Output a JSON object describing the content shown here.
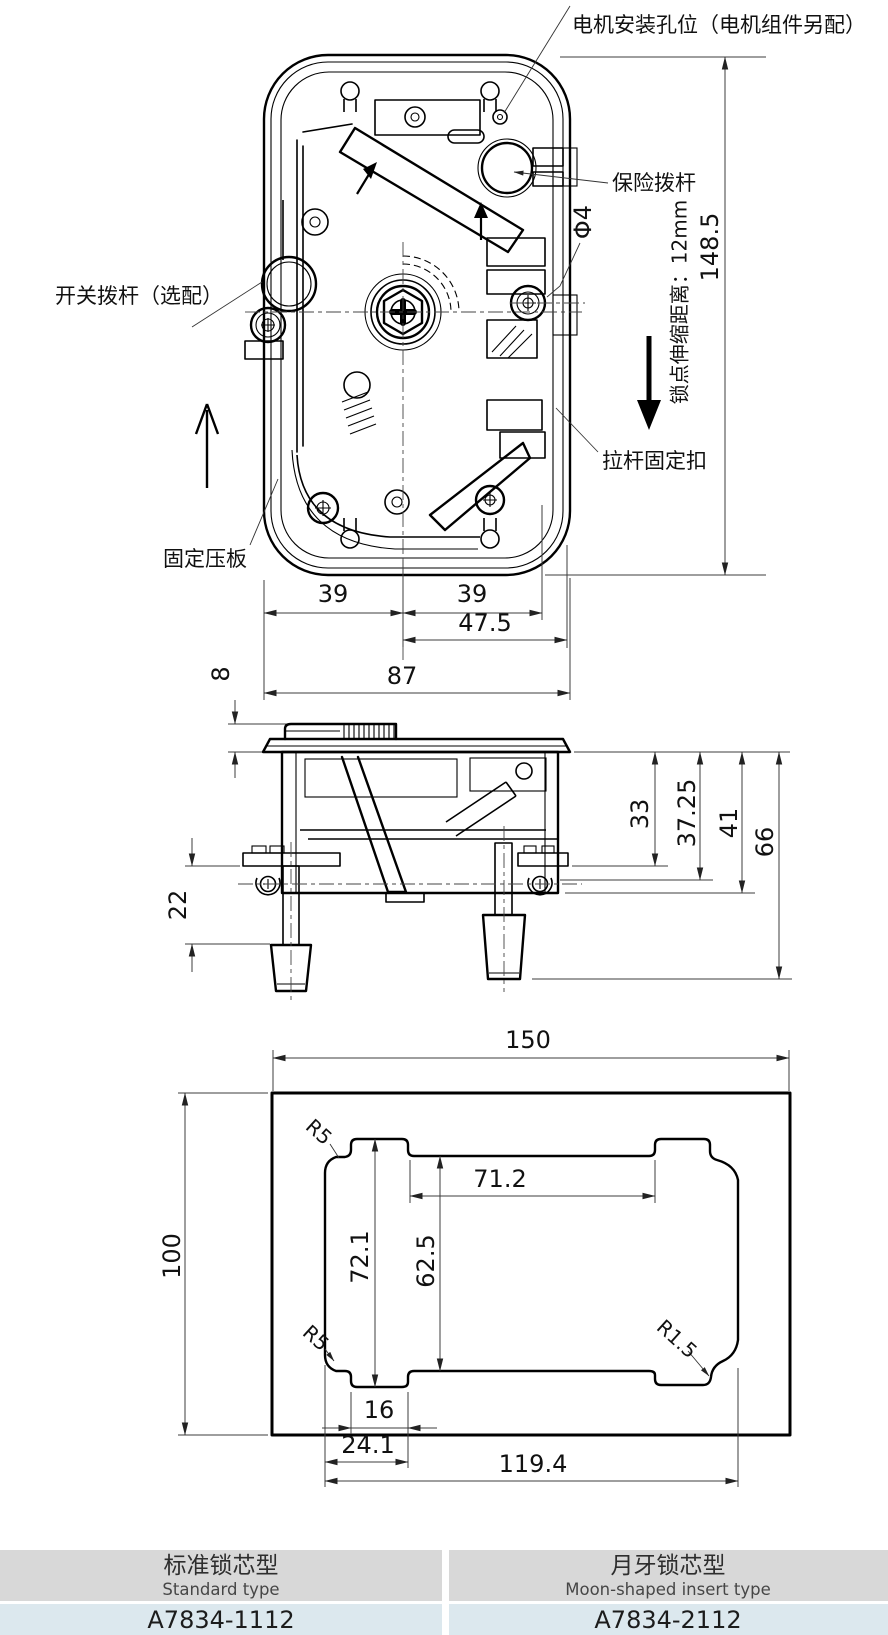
{
  "top_view": {
    "labels": {
      "motor_hole": "电机安装孔位（电机组件另配）",
      "safety_lever": "保险拨杆",
      "switch_lever": "开关拨杆（选配）",
      "fixing_plate": "固定压板",
      "rod_clip": "拉杆固定扣",
      "lock_stroke": "锁点伸缩距离：12mm",
      "hole_dia": "Φ4"
    },
    "dims": {
      "height": "148.5",
      "left_pitch": "39",
      "right_pitch": "39",
      "offset": "47.5",
      "width": "87",
      "plate_thickness": "8"
    }
  },
  "side_view": {
    "dims": {
      "d33": "33",
      "d37_25": "37.25",
      "d41": "41",
      "d66": "66",
      "rod_length": "22"
    }
  },
  "cutout_view": {
    "dims": {
      "panel_width": "150",
      "panel_height": "100",
      "top_opening": "71.2",
      "notch_span": "72.1",
      "opening_height": "62.5",
      "notch_width": "16",
      "notch_offset": "24.1",
      "opening_width": "119.4",
      "radius_top_left": "R5",
      "radius_bottom_left": "R5",
      "radius_bottom_right": "R1.5"
    }
  },
  "table": {
    "columns": [
      {
        "type_cn": "标准锁芯型",
        "type_en": "Standard type",
        "model": "A7834-1112"
      },
      {
        "type_cn": "月牙锁芯型",
        "type_en": "Moon-shaped insert type",
        "model": "A7834-2112"
      }
    ]
  }
}
